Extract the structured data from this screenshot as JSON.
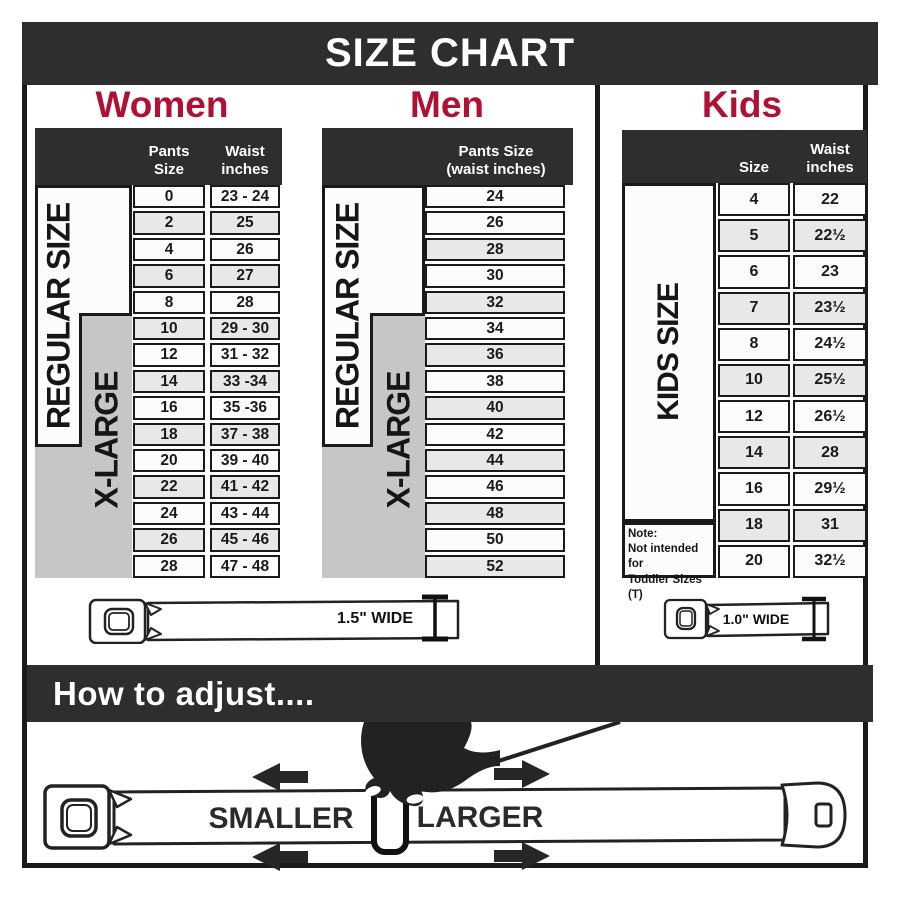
{
  "title": "SIZE CHART",
  "colors": {
    "accent": "#b01133",
    "dark": "#2e2e2e",
    "row_gray": "#e8e8e8",
    "xlarge_gray": "#c6c6c6"
  },
  "sections": {
    "women": {
      "heading": "Women",
      "col1_header": "Pants Size",
      "col2_header_line1": "Waist",
      "col2_header_line2": "inches",
      "regular_label": "REGULAR SIZE",
      "xlarge_label": "X-LARGE",
      "rows": [
        {
          "size": "0",
          "waist": "23 - 24"
        },
        {
          "size": "2",
          "waist": "25"
        },
        {
          "size": "4",
          "waist": "26"
        },
        {
          "size": "6",
          "waist": "27"
        },
        {
          "size": "8",
          "waist": "28"
        },
        {
          "size": "10",
          "waist": "29 - 30"
        },
        {
          "size": "12",
          "waist": "31 - 32"
        },
        {
          "size": "14",
          "waist": "33 -34"
        },
        {
          "size": "16",
          "waist": "35 -36"
        },
        {
          "size": "18",
          "waist": "37 - 38"
        },
        {
          "size": "20",
          "waist": "39 - 40"
        },
        {
          "size": "22",
          "waist": "41 - 42"
        },
        {
          "size": "24",
          "waist": "43 - 44"
        },
        {
          "size": "26",
          "waist": "45 - 46"
        },
        {
          "size": "28",
          "waist": "47 - 48"
        }
      ]
    },
    "men": {
      "heading": "Men",
      "col_header_line1": "Pants Size",
      "col_header_line2": "(waist inches)",
      "regular_label": "REGULAR SIZE",
      "xlarge_label": "X-LARGE",
      "rows": [
        "24",
        "26",
        "28",
        "30",
        "32",
        "34",
        "36",
        "38",
        "40",
        "42",
        "44",
        "46",
        "48",
        "50",
        "52"
      ]
    },
    "kids": {
      "heading": "Kids",
      "col1_header": "Size",
      "col2_header_line1": "Waist",
      "col2_header_line2": "inches",
      "side_label": "KIDS SIZE",
      "note_line1": "Note:",
      "note_line2": "Not intended for",
      "note_line3": "Toddler Sizes (T)",
      "rows": [
        {
          "size": "4",
          "waist": "22"
        },
        {
          "size": "5",
          "waist": "22½"
        },
        {
          "size": "6",
          "waist": "23"
        },
        {
          "size": "7",
          "waist": "23½"
        },
        {
          "size": "8",
          "waist": "24½"
        },
        {
          "size": "10",
          "waist": "25½"
        },
        {
          "size": "12",
          "waist": "26½"
        },
        {
          "size": "14",
          "waist": "28"
        },
        {
          "size": "16",
          "waist": "29½"
        },
        {
          "size": "18",
          "waist": "31"
        },
        {
          "size": "20",
          "waist": "32½"
        }
      ]
    }
  },
  "belts": {
    "adult_width_label": "1.5\" WIDE",
    "kids_width_label": "1.0\" WIDE"
  },
  "adjust": {
    "heading": "How to adjust....",
    "smaller_label": "SMALLER",
    "larger_label": "LARGER"
  }
}
